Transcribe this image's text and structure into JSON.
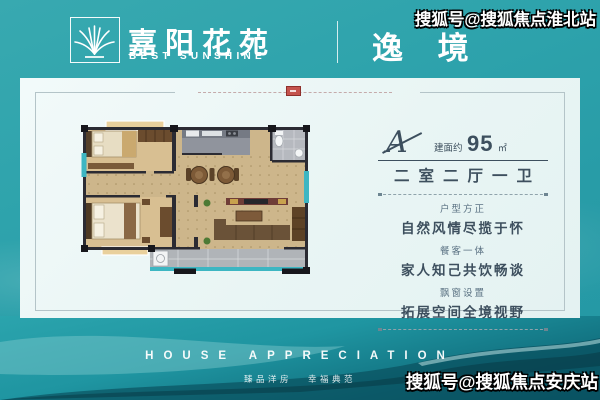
{
  "header": {
    "brand_name": "嘉阳花苑",
    "brand_sub": "BEST SUNSHINE",
    "series_title": "逸 境"
  },
  "watermarks": {
    "top_right": "搜狐号@搜狐焦点淮北站",
    "bottom_right": "搜狐号@搜狐焦点安庆站"
  },
  "unit_card": {
    "type_letter": "A",
    "area_label": "建面约",
    "area_value": "95",
    "area_unit": "㎡",
    "layout": "二室二厅一卫",
    "features": [
      {
        "caption": "户型方正",
        "detail": "自然风情尽揽于怀"
      },
      {
        "caption": "餐客一体",
        "detail": "家人知己共饮畅谈"
      },
      {
        "caption": "飘窗设置",
        "detail": "拓展空间全境视野"
      }
    ]
  },
  "footer": {
    "title": "HOUSE APPRECIATION",
    "slogan_left": "臻品洋房",
    "slogan_right": "幸福典范"
  },
  "colors": {
    "background_teal": "#2ba1ab",
    "card_bg": "#eaf6f5",
    "accent_red": "#b5413c",
    "text_dark": "#3d4f5e",
    "floorplan_wall": "#2b2b33",
    "floorplan_window": "#3db6c2",
    "floorplan_wood": "#cdb68b"
  }
}
